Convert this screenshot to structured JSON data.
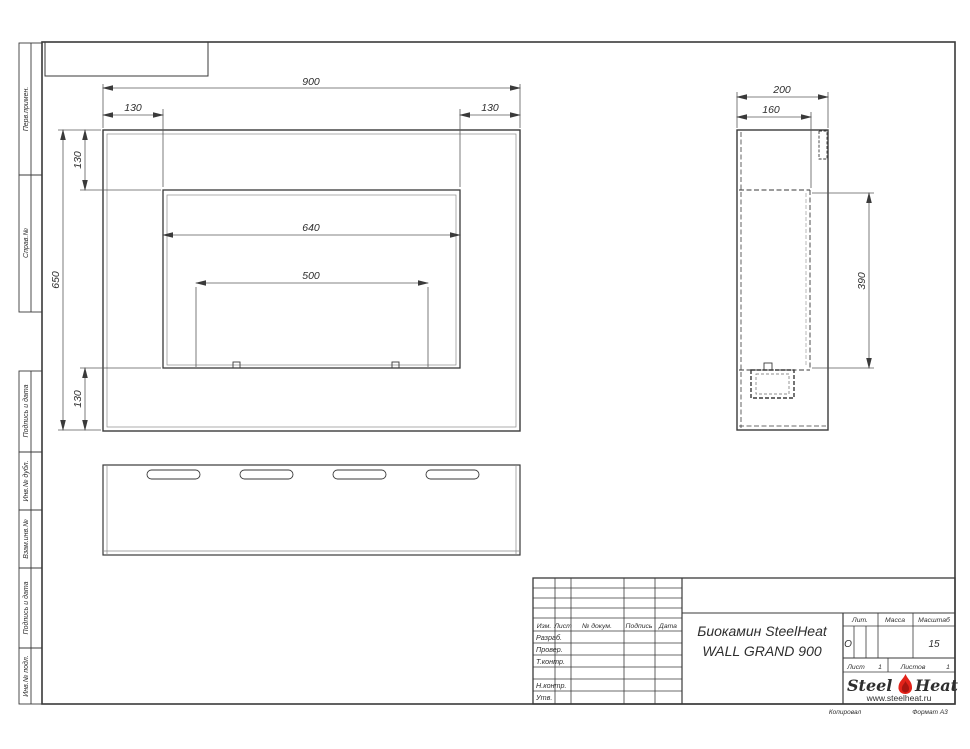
{
  "sheet": {
    "margin_labels": [
      {
        "label": "Перв.примен."
      },
      {
        "label": "Справ.№"
      },
      {
        "label": "Подпись и дата"
      },
      {
        "label": "Инв.№ дубл."
      },
      {
        "label": "Взам.инв.№"
      },
      {
        "label": "Подпись и дата"
      },
      {
        "label": "Инв.№ подл."
      }
    ],
    "footer": {
      "copied": "Копировал",
      "format": "Формат А3"
    }
  },
  "views": {
    "front": {
      "dims": {
        "overall_width": "900",
        "side_offset_left": "130",
        "side_offset_right": "130",
        "overall_height": "650",
        "top_offset": "130",
        "bottom_offset": "130",
        "opening_width": "640",
        "burner_slot_width": "500"
      }
    },
    "side": {
      "dims": {
        "overall_depth": "200",
        "inner_depth": "160",
        "opening_height": "390"
      }
    }
  },
  "title_block": {
    "doc_title_line1": "Биокамин SteelHeat",
    "doc_title_line2": "WALL GRAND 900",
    "col_headers": {
      "izm": "Изм.",
      "sheet": "Лист",
      "doc_num": "№ докум.",
      "signature": "Подпись",
      "date": "Дата"
    },
    "row_labels": {
      "developed": "Разраб.",
      "checked": "Провер.",
      "tcontrol": "Т.контр.",
      "ncontrol": "Н.контр.",
      "approved": "Утв."
    },
    "lit": {
      "label": "Лит.",
      "value": "О"
    },
    "mass": {
      "label": "Масса",
      "value": ""
    },
    "scale": {
      "label": "Масштаб",
      "value": "15"
    },
    "sheet_info": {
      "sheet_label": "Лист",
      "sheet_value": "1",
      "sheets_label": "Листов",
      "sheets_value": "1"
    },
    "brand": {
      "name_part1": "Steel",
      "name_part2": "Heat",
      "website": "www.steelheat.ru"
    }
  }
}
